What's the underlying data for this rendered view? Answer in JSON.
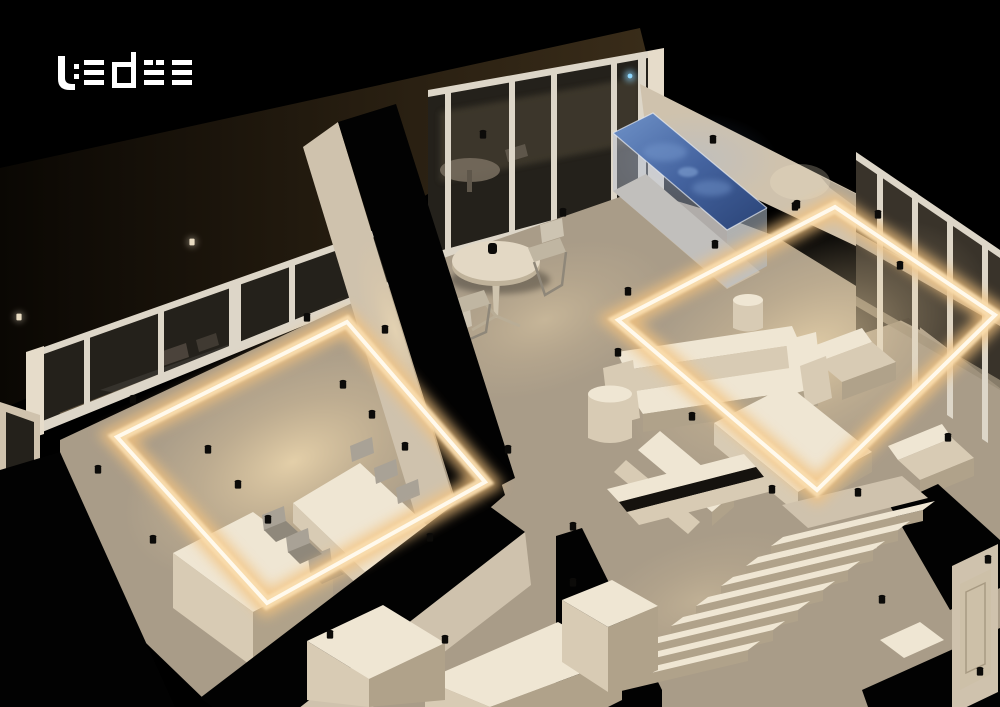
{
  "brand": {
    "name": "ledee"
  },
  "labels": {
    "scene": "3D apartment cutaway lighting render",
    "logo": "ledee logo",
    "exterior": "dark exterior terrace",
    "dining_room": "dining room",
    "terrace": "terrace seating area",
    "living_room": "living room",
    "pool": "glass pool with blue water",
    "hallway": "hallway with sideboard",
    "staircase": "staircase",
    "door": "door",
    "led_frame_dining": "suspended LED light frame - dining",
    "led_frame_living": "suspended LED light frame - living",
    "spotlights": "ceiling spotlights",
    "blue_accent": "blue accent light",
    "window_wall": "window wall",
    "glass_wall": "glass wall to balcony",
    "dining_table": "dining table",
    "kitchen_island": "kitchen island",
    "bistro_table": "bistro table",
    "sofa": "sofa",
    "armchair": "armchair",
    "coffee_table": "coffee table",
    "sideboard": "sideboard",
    "balcony_table": "balcony table"
  },
  "colors": {
    "background": "#000000",
    "logo": "#ffffff",
    "led_glow": "#f3c27f",
    "led_mid": "#f9ddae",
    "led_core": "#fff9ec",
    "wall_light": "#e6dcca",
    "wall_mid": "#cfc2ad",
    "wall_dark": "#9b8e79",
    "floor_mid": "#a99c88",
    "glass_dark": "#24211b",
    "frame_white": "#ddd6c8",
    "pool_water_light": "#6f92c8",
    "pool_water": "#44639f",
    "pool_water_deep": "#2a4376",
    "pool_glass": "#b7c2d2",
    "accent_blue": "#8fd8ff",
    "exterior_brown": "#2b2214",
    "furniture_light": "#efe6d3",
    "furniture_mid": "#d8cbb4",
    "furniture_dark": "#b0a28a",
    "chair_gray": "#a9a296",
    "spotlight_black": "#0c0b09"
  }
}
